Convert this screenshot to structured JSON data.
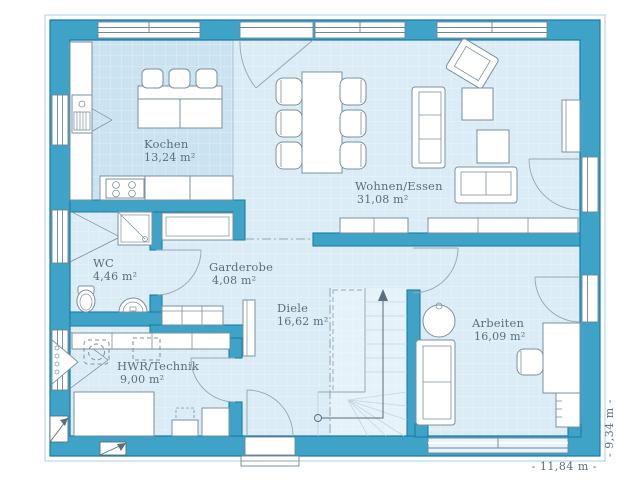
{
  "plan": {
    "rooms": [
      {
        "id": "kochen",
        "name": "Kochen",
        "area": "13,24 m²"
      },
      {
        "id": "wohnen",
        "name": "Wohnen/Essen",
        "area": "31,08 m²"
      },
      {
        "id": "wc",
        "name": "WC",
        "area": "4,46 m²"
      },
      {
        "id": "garderobe",
        "name": "Garderobe",
        "area": "4,08 m²"
      },
      {
        "id": "diele",
        "name": "Diele",
        "area": "16,62 m²"
      },
      {
        "id": "hwr",
        "name": "HWR/Technik",
        "area": "9,00 m²"
      },
      {
        "id": "arbeiten",
        "name": "Arbeiten",
        "area": "16,09 m²"
      }
    ],
    "dimensions": {
      "width_label": "- 11,84 m -",
      "height_label": "- 9,34 m -"
    },
    "colors": {
      "wall": "#3fa3c8",
      "wall_outline": "#1a7ca8",
      "floor": "#dbecf7",
      "floor_kitchen": "#cbe3f1",
      "text": "#5a6e7d"
    }
  }
}
